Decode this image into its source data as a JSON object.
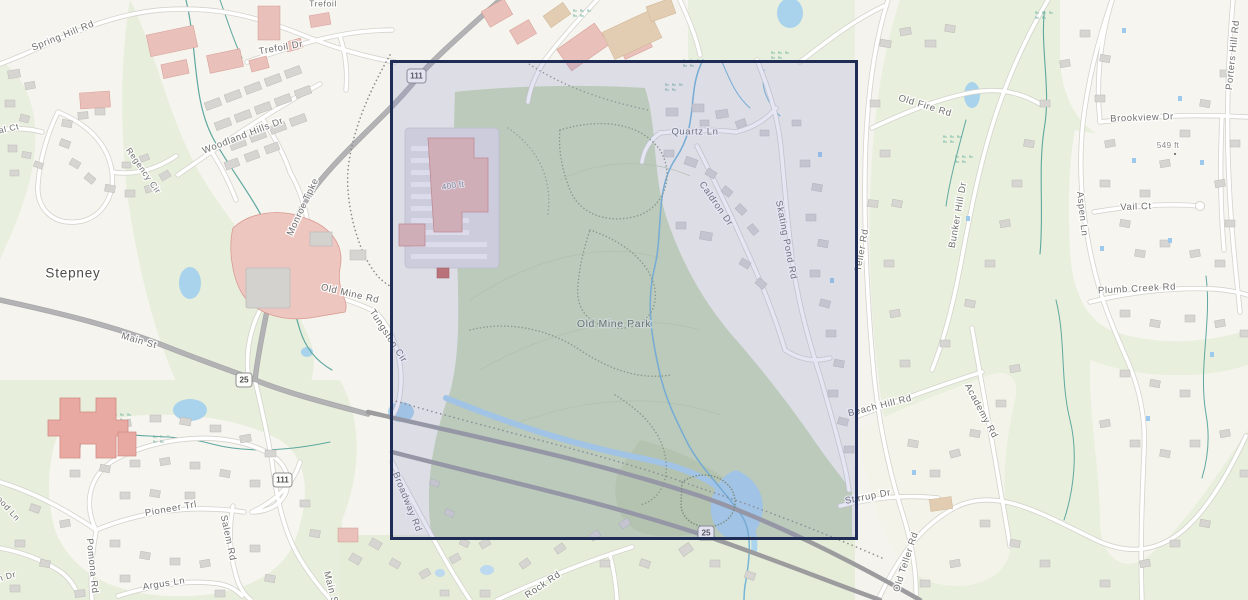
{
  "map": {
    "place_labels": {
      "stepney": "Stepney",
      "old_mine_park": "Old Mine Park"
    },
    "road_labels": {
      "spring_hill_rd": "Spring Hill Rd",
      "trefoil": "Trefoil",
      "trefoil_dr": "Trefoil Dr",
      "woodland_hills_dr": "Woodland Hills Dr",
      "al_ct_partial": "al Ct",
      "regency_cir": "Regency Cir",
      "monroe_tpke": "Monroe Tpke",
      "main_st": "Main St",
      "old_mine_rd": "Old Mine Rd",
      "tungsten_cir": "Tungsten Cir",
      "quartz_ln": "Quartz Ln",
      "caldron_dr": "Caldron Dr",
      "skating_pond_rd": "Skating Pond Rd",
      "teller_rd": "Teller Rd",
      "bunker_hill_dr": "Bunker Hill Dr",
      "old_fire_rd": "Old Fire Rd",
      "brookview_dr": "Brookview Dr",
      "porters_hill_rd": "Porters Hill Rd",
      "vail_ct": "Vail Ct",
      "aspen_ln": "Aspen Ln",
      "plumb_creek_rd": "Plumb Creek Rd",
      "beach_hill_rd": "Beach Hill Rd",
      "academy_rd": "Academy Rd",
      "stirrup_dr": "Stirrup Dr",
      "old_teller_rd": "Old Teller Rd",
      "broadway_rd": "Broadway Rd",
      "pioneer_trl": "Pioneer Trl",
      "salem_rd": "Salem Rd",
      "pomona_rd": "Pomona Rd",
      "argus_ln": "Argus Ln",
      "wood_ln_partial": "ood Ln",
      "n_dr_partial": "n Dr",
      "main_st_south": "Main St",
      "rock_rd": "Rock Rd"
    },
    "route_shields": {
      "rt111_north": "111",
      "rt25_junction": "25",
      "rt111_south": "111",
      "rt25_box": "25"
    },
    "elevation_labels": {
      "e549": "549 ft",
      "e400": "400 ft"
    },
    "colors": {
      "selection_border": "#1f2c56",
      "selection_fill": "rgba(125,130,202,0.20)",
      "park_green": "#cbdcb7",
      "forest_green": "#e7eedb",
      "water_blue": "#a9d3ec",
      "stream_teal": "#5fa8a0",
      "road_major_gray": "#a7a7a9",
      "building_commercial_pink": "#e9c0ba",
      "building_gray": "#d6d5d2",
      "background_cream": "#f5f4ee"
    }
  }
}
